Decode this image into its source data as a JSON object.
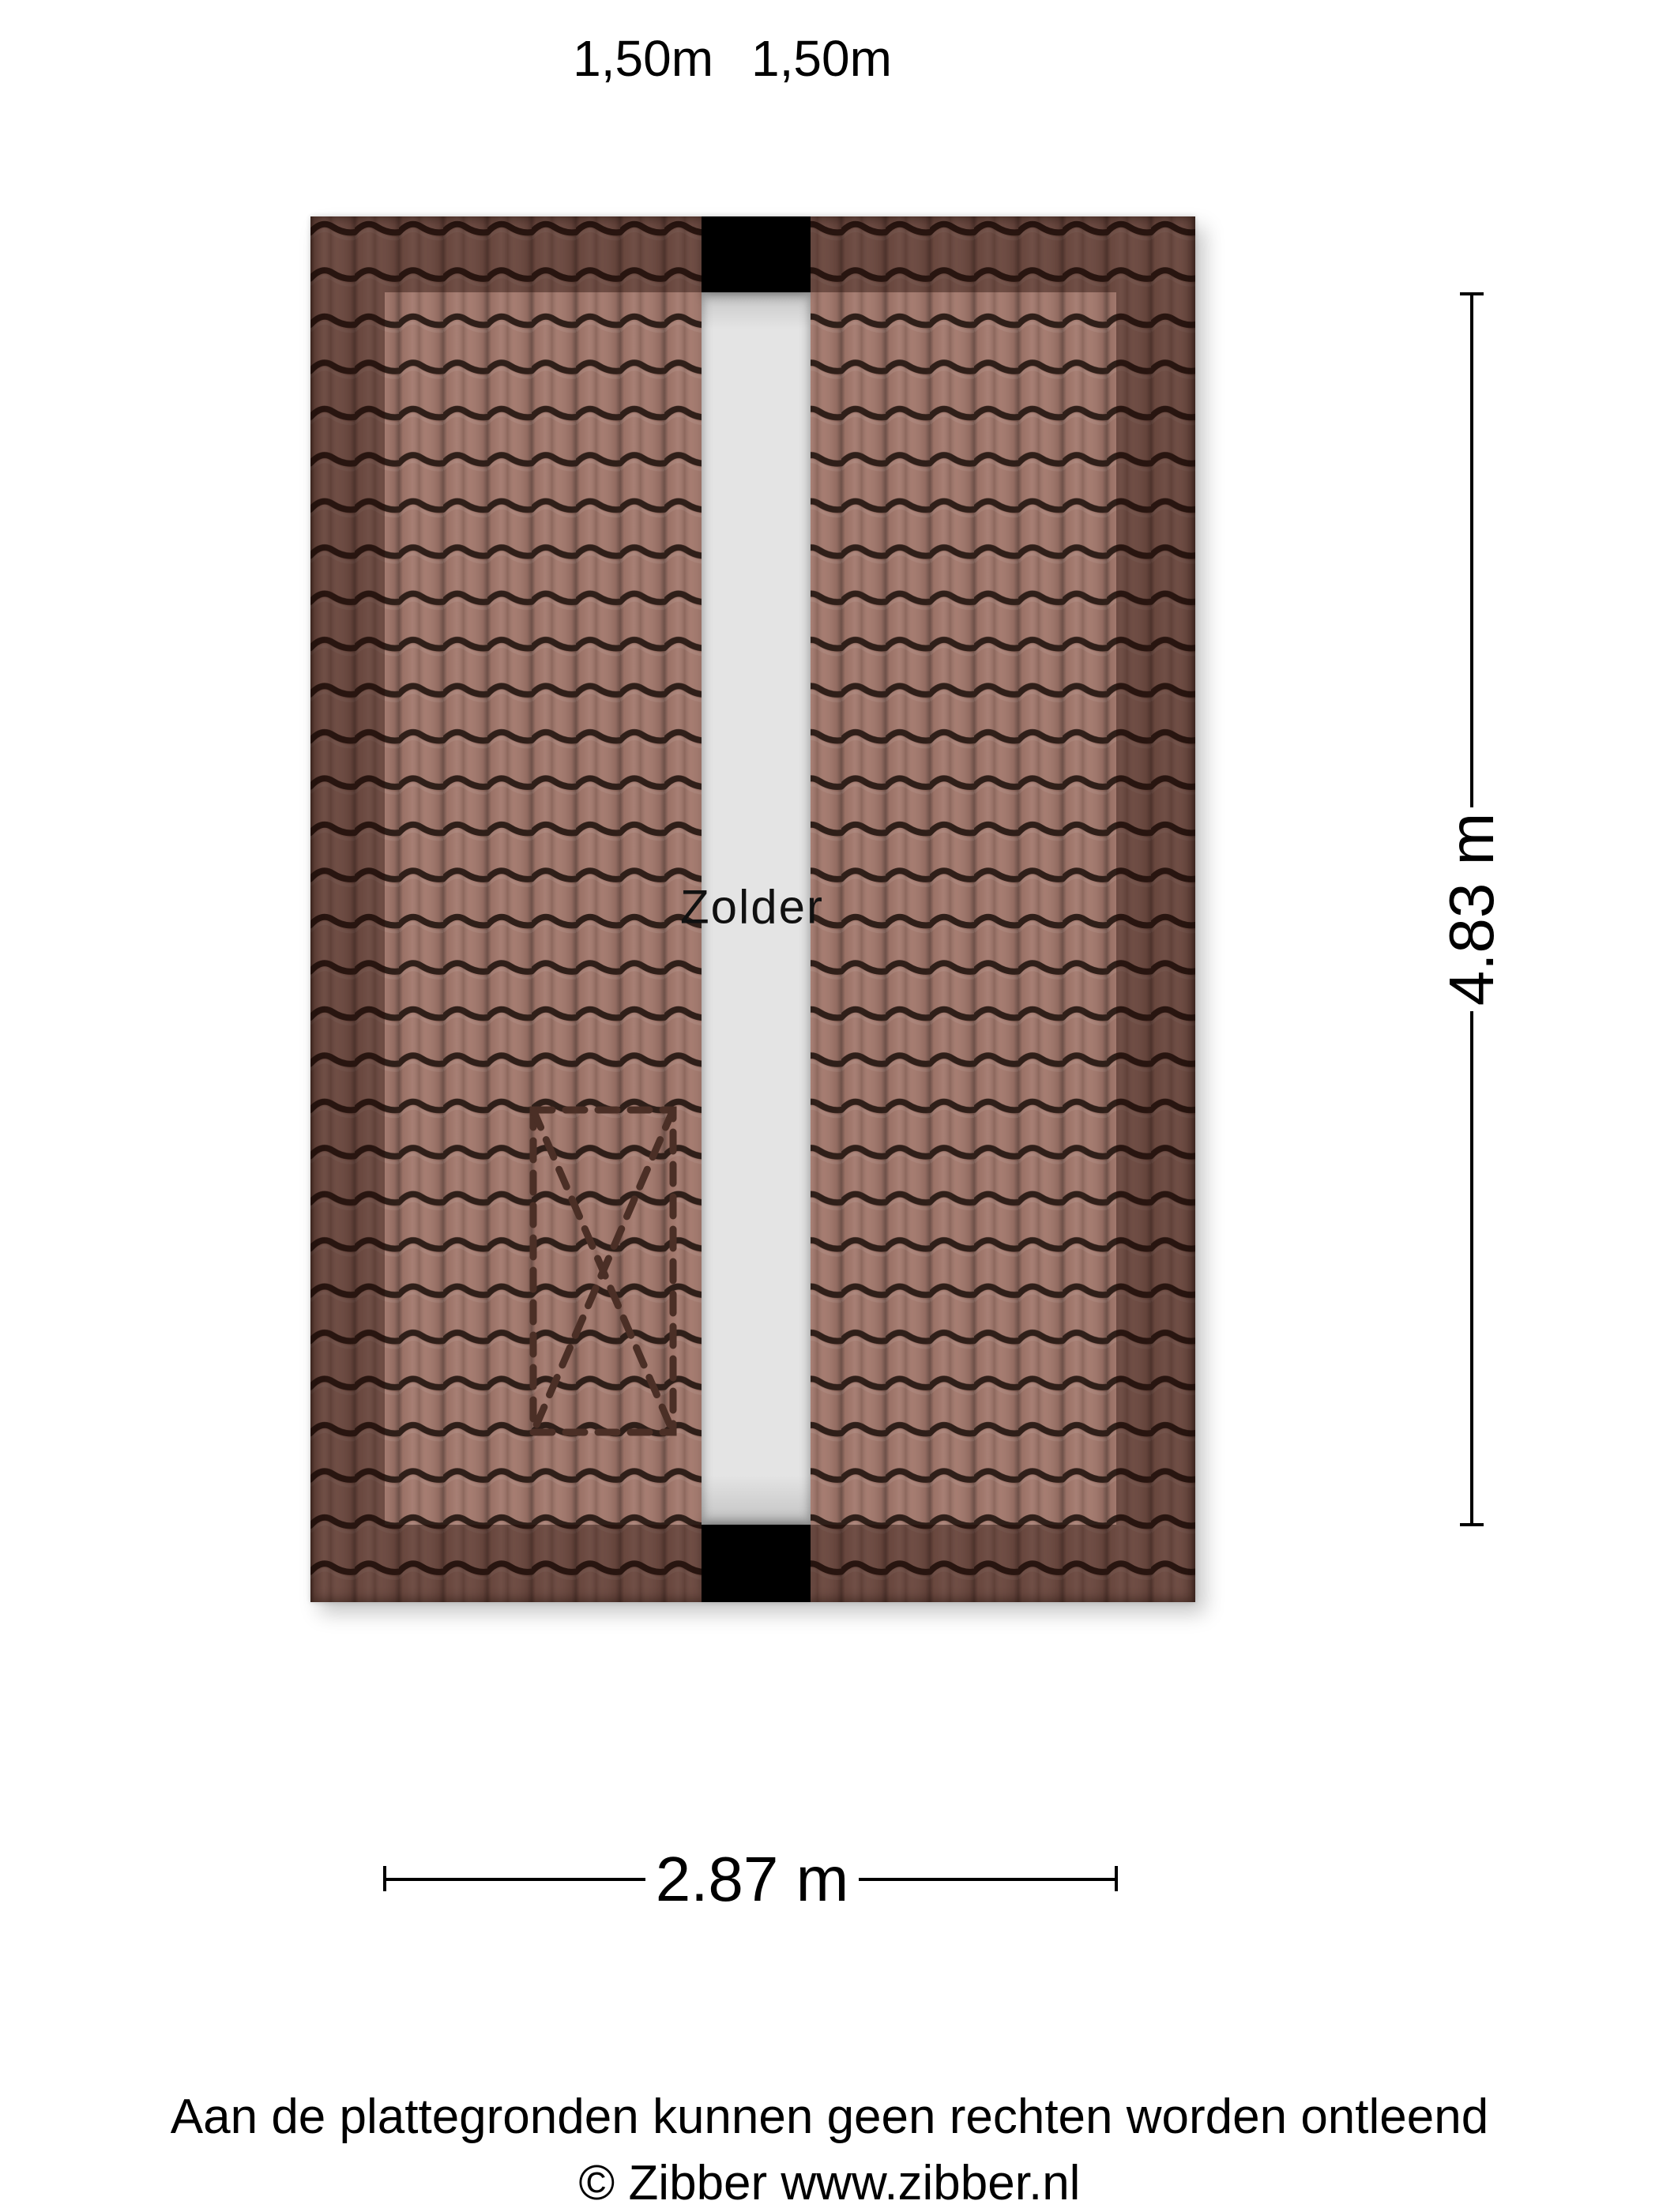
{
  "top_labels": {
    "left": "1,50m",
    "right": "1,50m"
  },
  "room": {
    "label": "Zolder"
  },
  "dimensions": {
    "vertical": "4.83 m",
    "horizontal": "2.87 m"
  },
  "footer": {
    "disclaimer": "Aan de plattegronden kunnen geen rechten worden ontleend",
    "copyright": "© Zibber www.zibber.nl"
  },
  "colors": {
    "background": "#ffffff",
    "tile_base": "#a2776b",
    "tile_wave_line": "#2f1f19",
    "roof_border_shade": "rgba(30,8,2,0.40)",
    "walkway_gray": "#e4e4e4",
    "opening_black": "#000000",
    "stairs_dash_brown": "#4b2f26",
    "text": "#000000"
  }
}
